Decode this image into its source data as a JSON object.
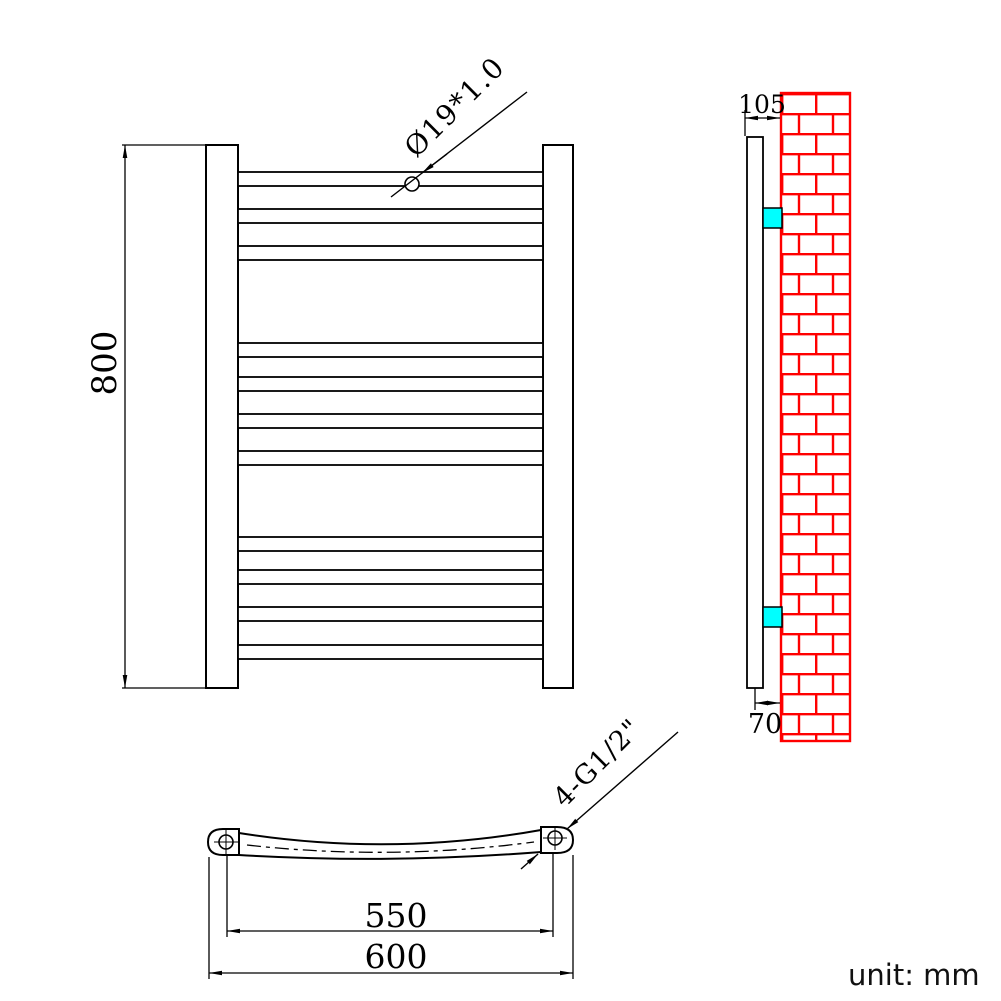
{
  "drawing": {
    "unit_note": "unit: mm",
    "front_view": {
      "height_label": "800",
      "tube_spec_label": "Ø19*1.0",
      "bar_count": 11
    },
    "side_view": {
      "depth_label": "105",
      "wall_offset_label": "70"
    },
    "bottom_view": {
      "center_distance_label": "550",
      "overall_width_label": "600",
      "thread_label": "4-G1/2\""
    },
    "colors": {
      "line_black": "#000000",
      "brick_red": "#FF0000",
      "bracket_cyan": "#00FFFF",
      "background": "#FFFFFF"
    }
  }
}
